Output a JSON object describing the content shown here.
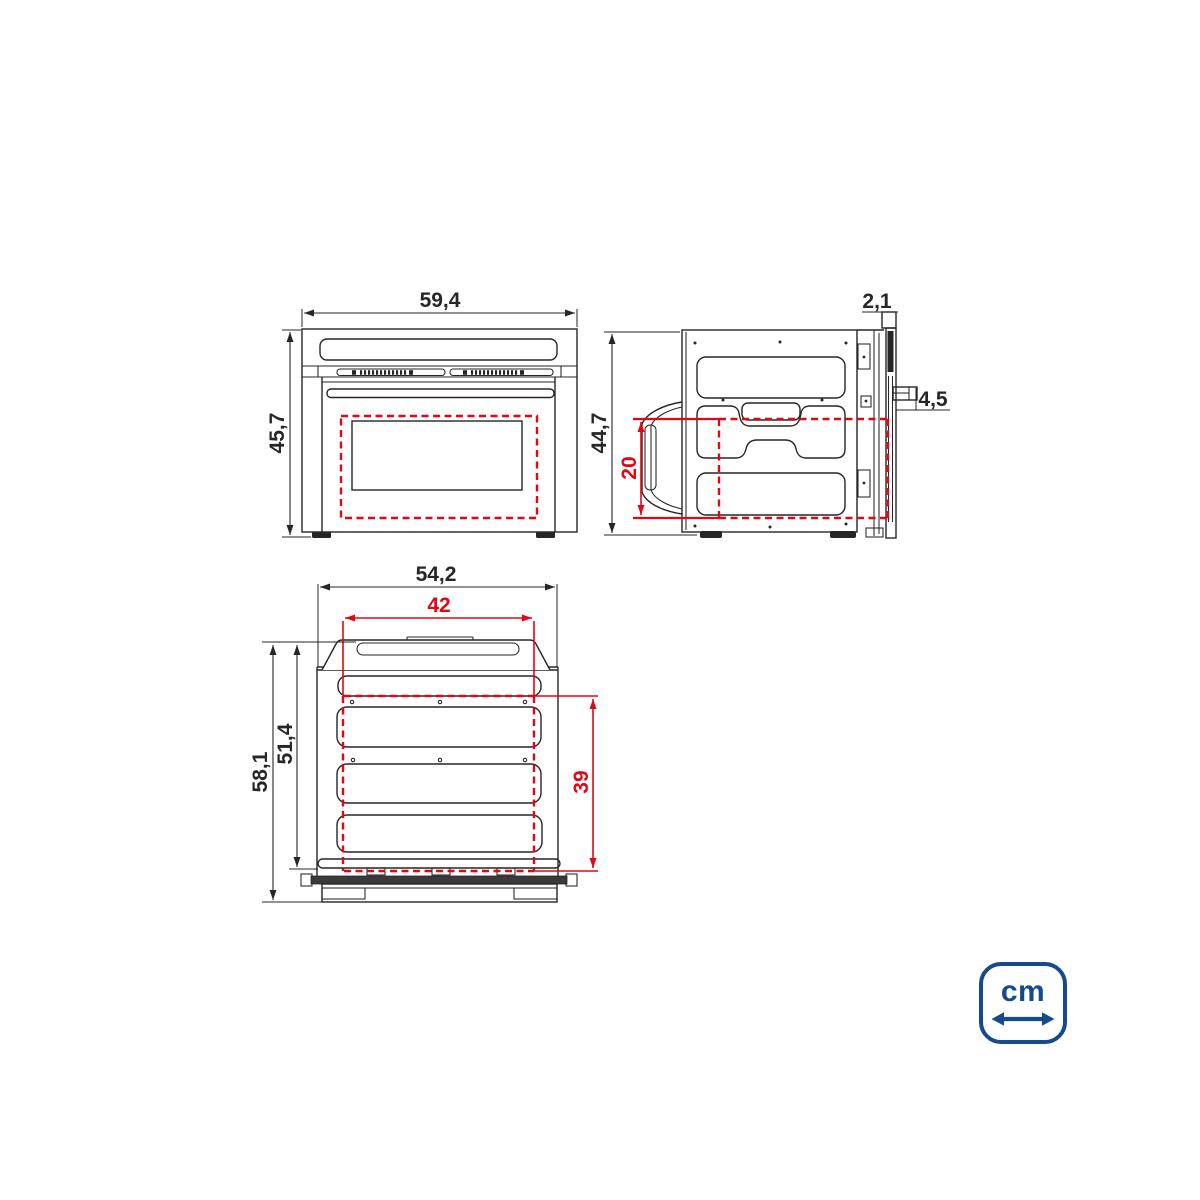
{
  "drawing_title": "Built-in oven dimensional drawing",
  "views": {
    "front": {
      "name": "front-view",
      "dims": {
        "width": "59,4",
        "height": "45,7"
      }
    },
    "side": {
      "name": "side-view",
      "dims": {
        "door_thickness": "2,1",
        "height": "44,7",
        "handle_depth": "4,5",
        "niche_height": "20"
      }
    },
    "top": {
      "name": "top-view",
      "dims": {
        "width": "54,2",
        "niche_width": "42",
        "total_depth": "58,1",
        "body_depth": "51,4",
        "niche_depth": "39"
      }
    }
  },
  "unit_badge": {
    "label": "cm",
    "icon": "double-arrow-icon"
  },
  "colors": {
    "line_black": "#262626",
    "dimension_red": "#e30613",
    "brand_blue": "#164a8c"
  }
}
